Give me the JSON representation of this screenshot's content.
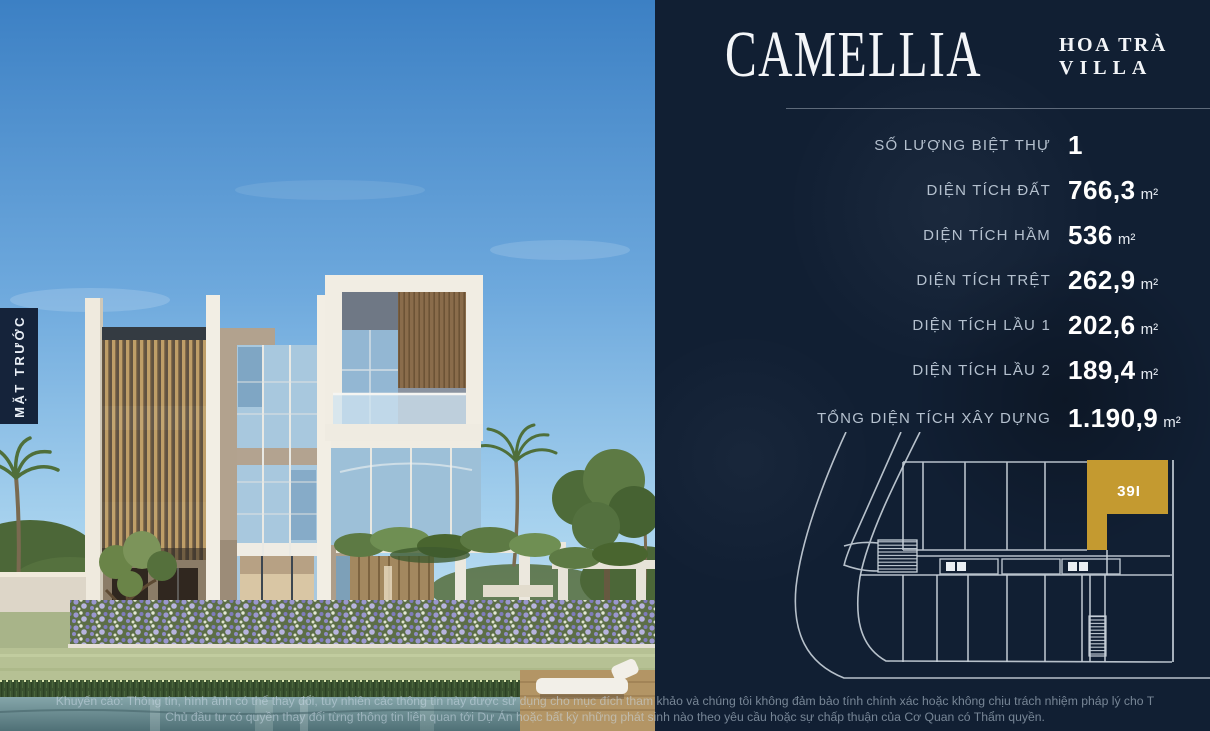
{
  "brand": {
    "title": "CAMELLIA",
    "subtitle_top": "HOA TRÀ",
    "subtitle_bottom": "VILLA"
  },
  "photo": {
    "view_label": "MẶT TRƯỚC"
  },
  "specs": [
    {
      "label": "SỐ LƯỢNG BIỆT THỰ",
      "value": "1",
      "unit": ""
    },
    {
      "label": "DIỆN TÍCH ĐẤT",
      "value": "766,3",
      "unit": "m²"
    },
    {
      "label": "DIỆN TÍCH HẦM",
      "value": "536",
      "unit": "m²"
    },
    {
      "label": "DIỆN TÍCH TRỆT",
      "value": "262,9",
      "unit": "m²"
    },
    {
      "label": "DIỆN TÍCH LẦU 1",
      "value": "202,6",
      "unit": "m²"
    },
    {
      "label": "DIỆN TÍCH LẦU 2",
      "value": "189,4",
      "unit": "m²"
    },
    {
      "label": "TỔNG DIỆN TÍCH XÂY DỰNG",
      "value": "1.190,9",
      "unit": "m²"
    }
  ],
  "site_plan": {
    "highlighted_lot": "39I",
    "highlight_color": "#c49a30"
  },
  "disclaimer": {
    "line1": "Khuyến cáo: Thông tin, hình ảnh có thể thay đổi, tuy nhiên các thông tin này được sử dụng cho mục đích tham khảo và chúng tôi không đảm bảo tính chính xác hoặc không chịu trách nhiệm pháp lý cho T",
    "line2": "Chủ đầu tư có quyền thay đổi từng thông tin liên quan tới Dự Án hoặc bất kỳ những phát sinh nào theo yêu cầu hoặc sự chấp thuận của Cơ Quan có Thẩm quyền."
  },
  "colors": {
    "panel_bg": "#111f33",
    "accent_gold": "#c49a30",
    "label_text": "#b4c0ce",
    "value_text": "#ffffff",
    "map_line": "#c6cfd8"
  }
}
